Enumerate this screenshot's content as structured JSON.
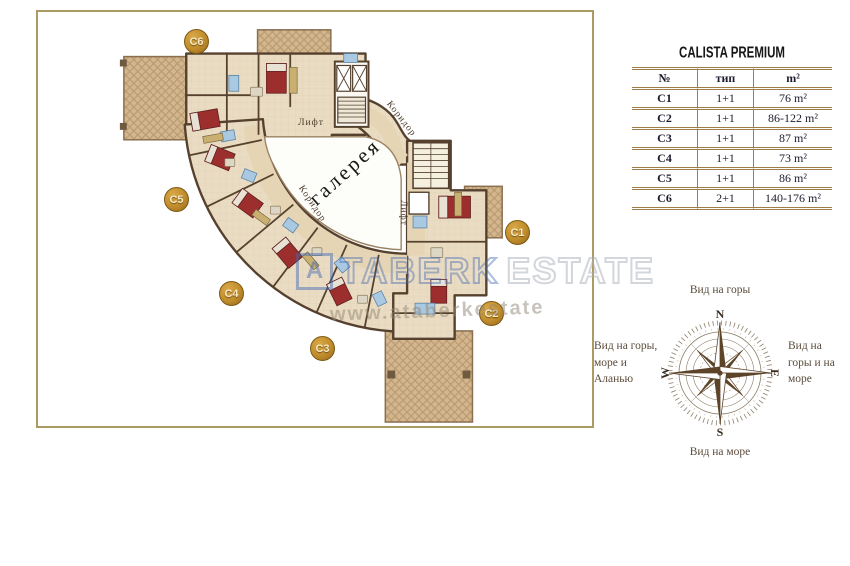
{
  "plan": {
    "badges": {
      "c1": "C1",
      "c2": "C2",
      "c3": "C3",
      "c4": "C4",
      "c5": "C5",
      "c6": "C6"
    },
    "labels": {
      "gallery": "галерея",
      "corridor": "Коридор",
      "elevator": "Лифт"
    }
  },
  "watermark": {
    "logo_letter": "A",
    "brand_part1": "TABERK",
    "brand_part2": "ESTATE",
    "url_line": "www.ataberkestate"
  },
  "table": {
    "title": "CALISTA PREMIUM",
    "columns": [
      "№",
      "тип",
      "m²"
    ],
    "rows": [
      {
        "no": "C1",
        "type": "1+1",
        "area": "76 m²"
      },
      {
        "no": "C2",
        "type": "1+1",
        "area": "86-122 m²"
      },
      {
        "no": "C3",
        "type": "1+1",
        "area": "87 m²"
      },
      {
        "no": "C4",
        "type": "1+1",
        "area": "73 m²"
      },
      {
        "no": "C5",
        "type": "1+1",
        "area": "86 m²"
      },
      {
        "no": "C6",
        "type": "2+1",
        "area": "140-176 m²"
      }
    ]
  },
  "compass": {
    "top_label": "Вид на горы",
    "bottom_label": "Вид на море",
    "left_label": "Вид на горы,\nморе и\nАланью",
    "right_label": "Вид на\nгоры и на\nморе",
    "north": "N",
    "south": "S",
    "west": "W",
    "east": "E"
  },
  "colors": {
    "frame_border": "#ab9b62",
    "wall": "#55412e",
    "floor": "#eadcc2",
    "corridor": "#e6d5b5",
    "terrace": "#d3b68e",
    "bed_red": "#9c2e2e",
    "fixture_blue": "#a9c9e2",
    "badge_gold": "#c08c2c",
    "compass_brown": "#5d4428",
    "watermark_blue": "#4067b4"
  }
}
